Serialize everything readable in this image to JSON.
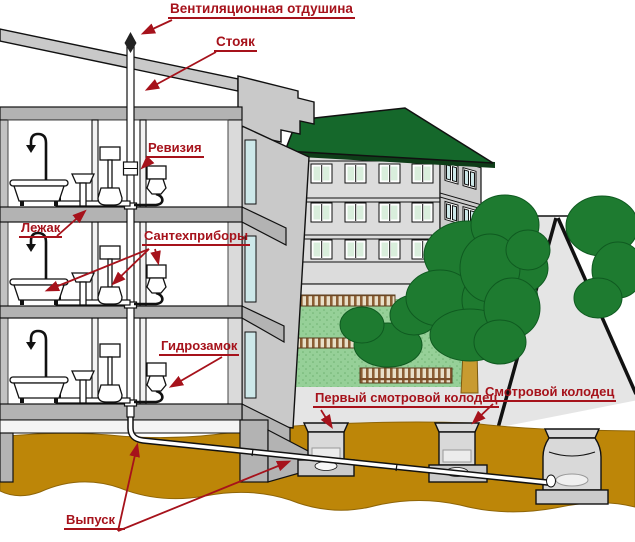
{
  "diagram": {
    "labels": {
      "vent_opening": "Вентиляционная отдушина",
      "riser": "Стояк",
      "revision": "Ревизия",
      "horizontal_drain": "Лежак",
      "fixtures": "Сантехприборы",
      "water_trap": "Гидрозамок",
      "first_inspection_well": "Первый смотровой колодец",
      "inspection_well": "Смотровой колодец",
      "outlet": "Выпуск"
    }
  },
  "colors": {
    "label_red": "#A6121B",
    "ground_ochre": "#BD8608",
    "roof_green": "#15682B",
    "tree_green": "#1E7B30",
    "lawn_green": "#96D098",
    "fence_brown": "#8B5E34",
    "trunk_brown": "#C89B30",
    "pavement_gray": "#E5E5E5",
    "glass_green": "#D9EEDC",
    "glass_blue": "#CDE8E9"
  }
}
